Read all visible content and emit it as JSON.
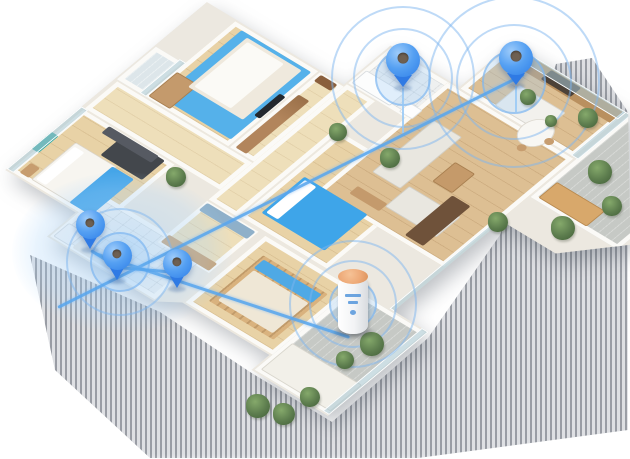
{
  "scene": {
    "title": "Isometric 3D apartment floor plan with smart home signal coverage",
    "background": "#ffffff"
  },
  "colors": {
    "pin_blue": "#3f8bef",
    "signal_ring_blue": "#7db6f0",
    "network_line_blue": "#5aa7ee",
    "carpet_blue": "#55b1ea",
    "bed_blanket_blue": "#3ea5e9",
    "wood_floor": "#e3c89c",
    "wall_white": "#fbfaf7",
    "device_cap_copper": "#eda876",
    "shadow_gray": "#5c626c"
  },
  "rooms": [
    {
      "name": "master-bedroom"
    },
    {
      "name": "bedroom-2"
    },
    {
      "name": "balcony-top"
    },
    {
      "name": "hallway"
    },
    {
      "name": "entry"
    },
    {
      "name": "bathroom"
    },
    {
      "name": "laundry-bathroom"
    },
    {
      "name": "walk-in-closet"
    },
    {
      "name": "middle-bedroom"
    },
    {
      "name": "living-room"
    },
    {
      "name": "kitchen"
    },
    {
      "name": "dining-area"
    },
    {
      "name": "small-bedroom"
    },
    {
      "name": "balcony-bottom"
    },
    {
      "name": "balcony-right"
    }
  ],
  "pins": [
    {
      "room": "bathroom",
      "x": 403,
      "y": 88,
      "size": 34
    },
    {
      "room": "kitchen",
      "x": 516,
      "y": 86,
      "size": 34
    },
    {
      "room": "laundry",
      "x": 90,
      "y": 250,
      "size": 29
    },
    {
      "room": "bathroom-2",
      "x": 117,
      "y": 281,
      "size": 29
    },
    {
      "room": "hallway",
      "x": 177,
      "y": 289,
      "size": 29
    }
  ],
  "signals": [
    {
      "x": 403,
      "y": 78,
      "radii": [
        28,
        50,
        72
      ]
    },
    {
      "x": 514,
      "y": 82,
      "radii": [
        32,
        58,
        86
      ]
    },
    {
      "x": 353,
      "y": 304,
      "radii": [
        24,
        44,
        64
      ]
    },
    {
      "x": 120,
      "y": 262,
      "radii": [
        30,
        54
      ]
    }
  ],
  "coverage": {
    "x": 122,
    "y": 252,
    "rx": 110,
    "ry": 80
  },
  "network_lines": [
    {
      "x1": 58,
      "y1": 306,
      "x2": 524,
      "y2": 73
    },
    {
      "x1": 95,
      "y1": 252,
      "x2": 350,
      "y2": 336
    },
    {
      "x1": 91,
      "y1": 249,
      "x2": 118,
      "y2": 266
    },
    {
      "x1": 118,
      "y1": 266,
      "x2": 177,
      "y2": 271
    }
  ],
  "signal_drops": [
    {
      "x": 403,
      "y": 88,
      "h": 45
    },
    {
      "x": 516,
      "y": 86,
      "h": 26
    }
  ],
  "device": {
    "name": "smart-home-hub",
    "x": 338,
    "y": 276,
    "w": 30,
    "h": 58
  },
  "plants": [
    {
      "x": 176,
      "y": 177,
      "r": 10
    },
    {
      "x": 338,
      "y": 132,
      "r": 9
    },
    {
      "x": 390,
      "y": 158,
      "r": 10
    },
    {
      "x": 528,
      "y": 97,
      "r": 8
    },
    {
      "x": 551,
      "y": 121,
      "r": 6
    },
    {
      "x": 588,
      "y": 118,
      "r": 10
    },
    {
      "x": 600,
      "y": 172,
      "r": 12
    },
    {
      "x": 563,
      "y": 228,
      "r": 12
    },
    {
      "x": 612,
      "y": 206,
      "r": 10
    },
    {
      "x": 498,
      "y": 222,
      "r": 10
    },
    {
      "x": 258,
      "y": 406,
      "r": 12
    },
    {
      "x": 284,
      "y": 414,
      "r": 11
    },
    {
      "x": 310,
      "y": 397,
      "r": 10
    },
    {
      "x": 372,
      "y": 344,
      "r": 12
    },
    {
      "x": 345,
      "y": 360,
      "r": 9
    }
  ]
}
